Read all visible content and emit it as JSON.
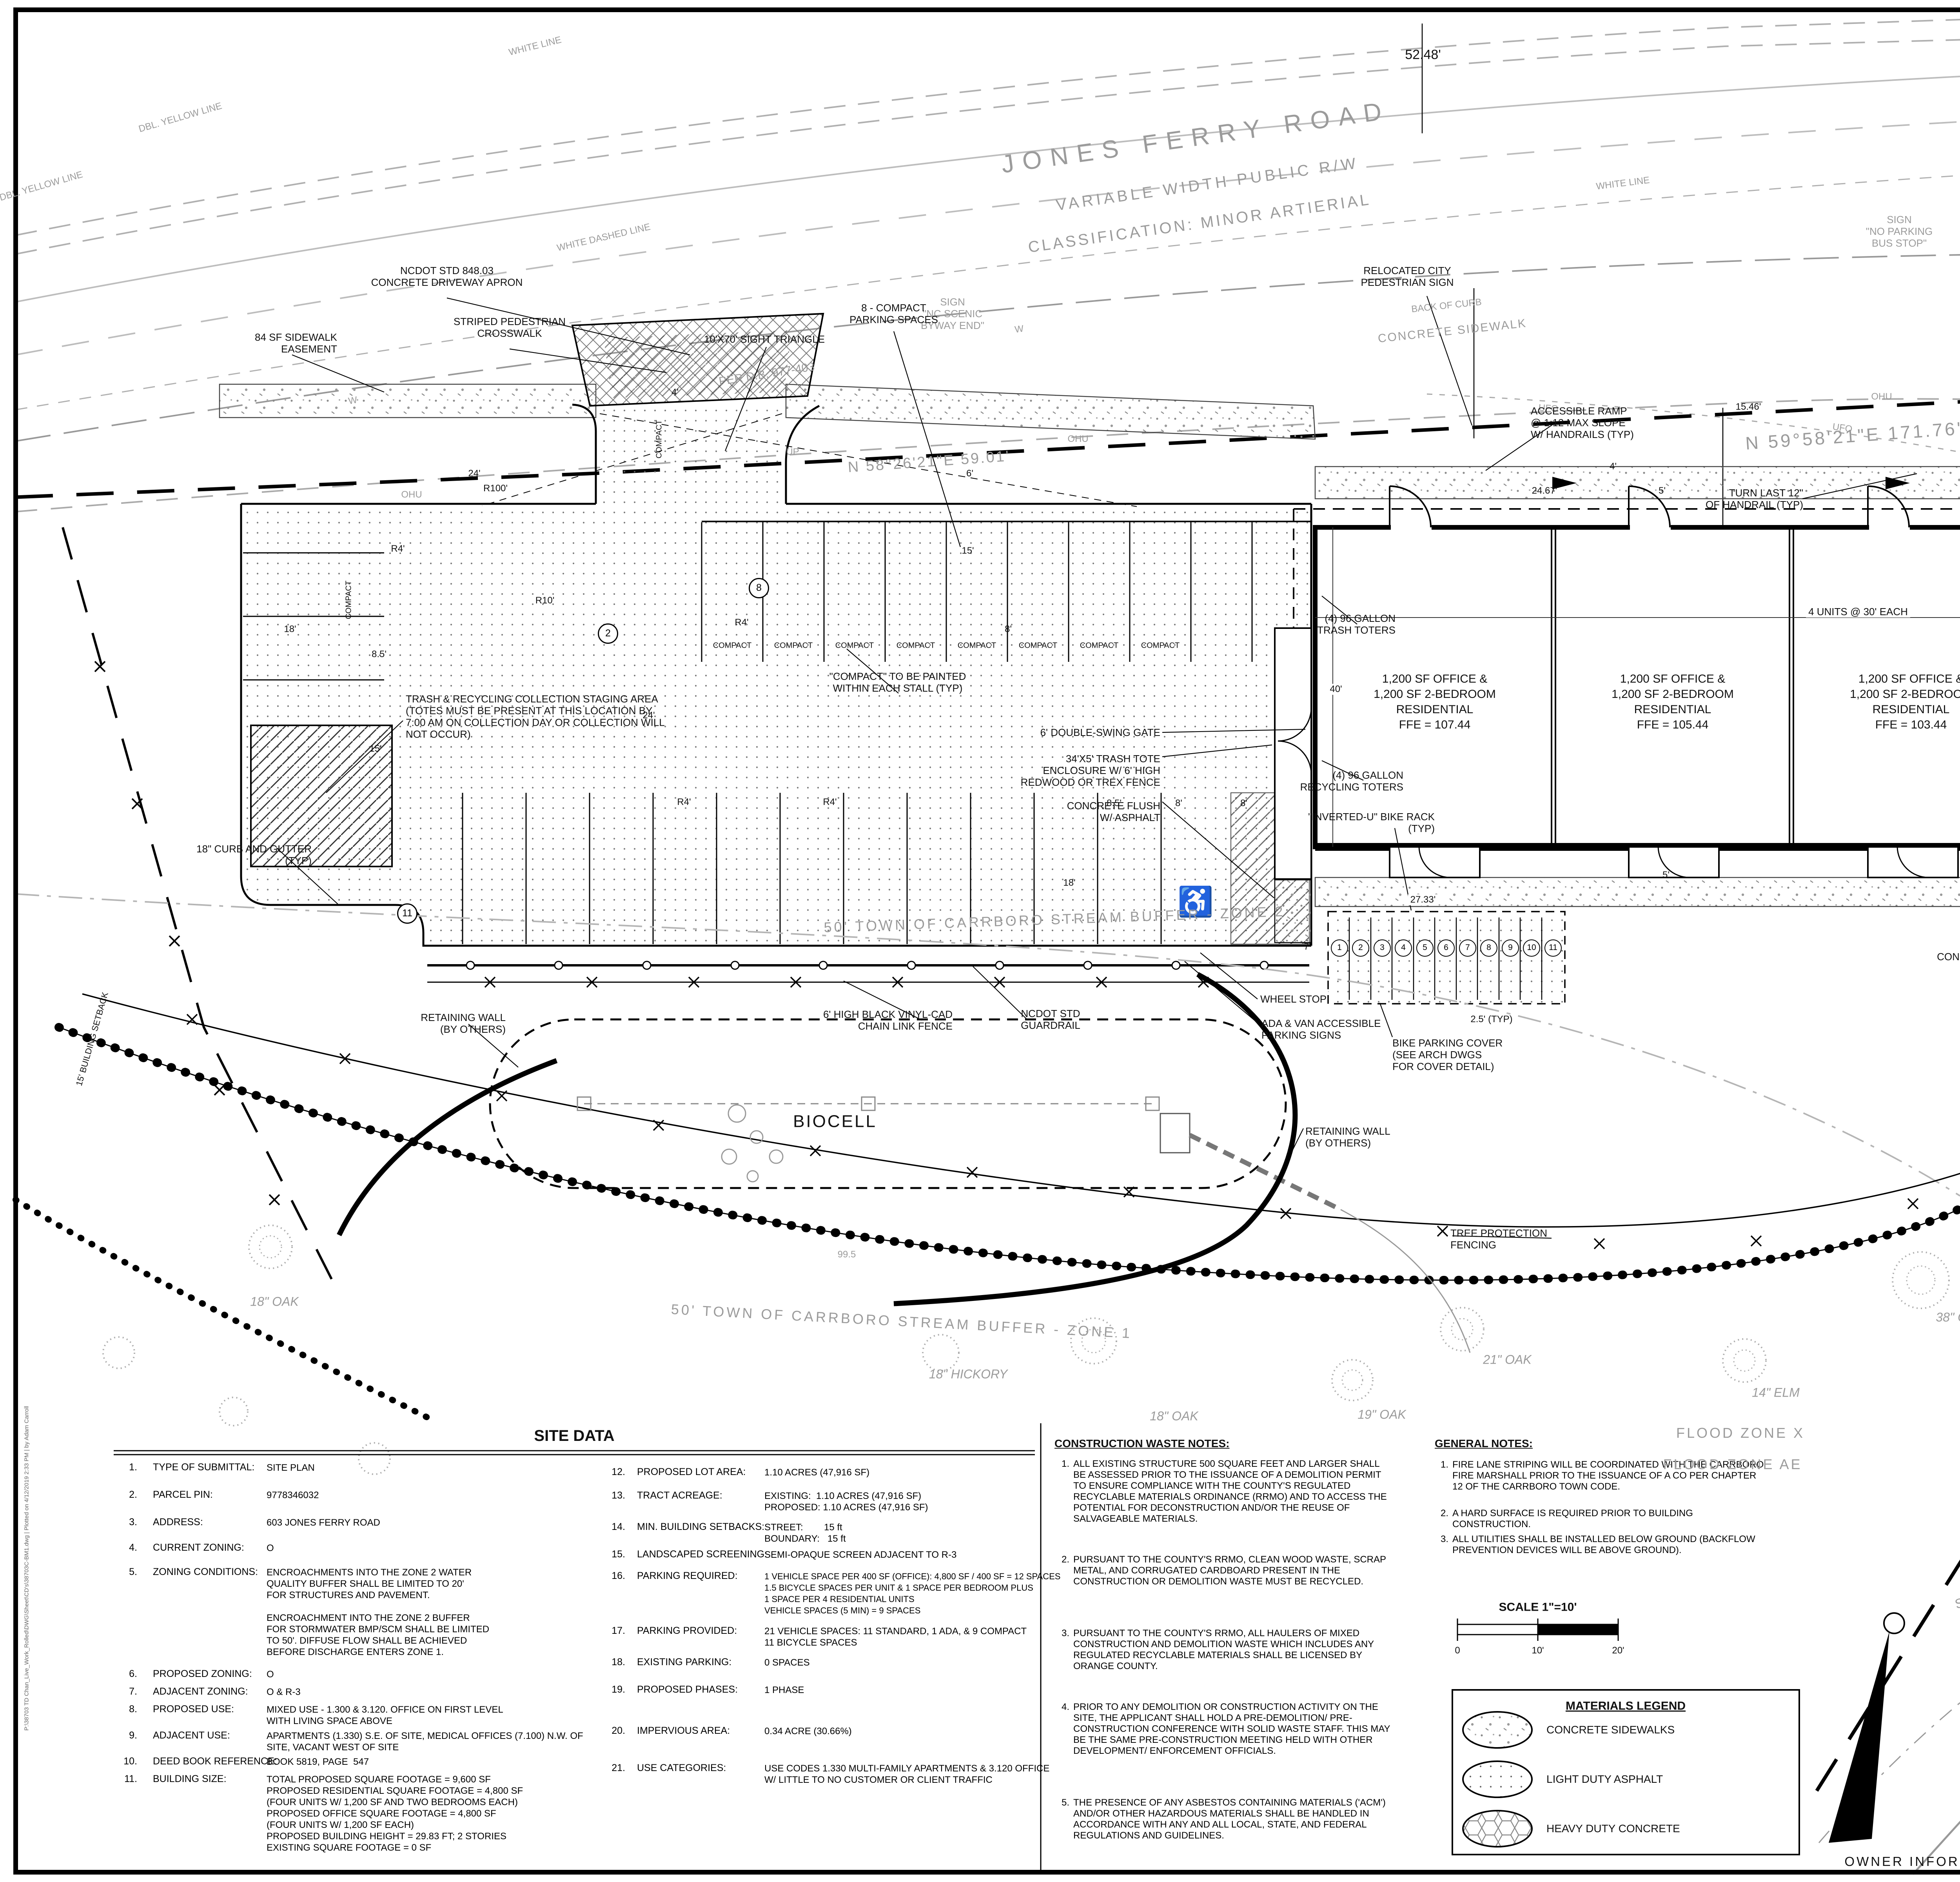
{
  "road": {
    "name": "JONES FERRY ROAD",
    "rw": "VARIABLE WIDTH PUBLIC R/W",
    "classification": "CLASSIFICATION: MINOR ARTIERIAL",
    "dim_5248": "52.48'",
    "dbl_yellow": "DBL. YELLOW LINE",
    "white_line": "WHITE LINE",
    "white_dashed": "WHITE DASHED LINE",
    "back_of_curb": "BACK OF CURB",
    "concrete_sidewalk": "CONCRETE SIDEWALK",
    "w": "W",
    "ohu": "OHU",
    "ufo": "UFO",
    "up": "UP",
    "per_db_977": "PER D.B. 977-403",
    "per_db_885": "PER D.B. 885-233",
    "bearing_n59": "N 59°58'21\"E  171.76'",
    "bearing_n58": "N 58°26'21\"E  59.01'"
  },
  "labels": {
    "sign_scenic": "SIGN\n\"NC SCENIC\nBYWAY END\"",
    "sign_bus": "SIGN\n\"NO PARKING\nBUS STOP\"",
    "sign_jct": "SIGN\n\"JCT 54\"",
    "relocated_sign": "RELOCATED CITY\nPEDESTRIAN SIGN",
    "ncdot_apron": "NCDOT STD 848.03\nCONCRETE DRIVEWAY APRON",
    "sidewalk_easement": "84 SF SIDEWALK\nEASEMENT",
    "crosswalk": "STRIPED PEDESTRIAN\nCROSSWALK",
    "sight_triangle": "10'X70' SIGHT TRIANGLE",
    "compact_8": "8 - COMPACT\nPARKING SPACES",
    "compact": "COMPACT",
    "compact_note": "\"COMPACT\" TO BE PAINTED\nWITHIN EACH STALL (TYP)",
    "gate": "6' DOUBLE-SWING GATE",
    "tote_enclosure": "34'X5' TRASH TOTE\nENCLOSURE W/ 6' HIGH\nREDWOOD OR TREX FENCE",
    "conc_flush": "CONCRETE FLUSH\nW/ ASPHALT",
    "trash_staging": "TRASH & RECYCLING COLLECTION STAGING AREA\n(TOTES MUST BE PRESENT AT THIS LOCATION BY\n7:00 AM ON COLLECTION DAY OR COLLECTION WILL\nNOT OCCUR)",
    "curb_gutter": "18\" CURB AND GUTTER\n(TYP)",
    "stream_zone2": "50' TOWN OF CARRBORO STREAM BUFFER - ZONE 2",
    "stream_zone1": "50' TOWN OF CARRBORO STREAM BUFFER - ZONE 1",
    "setback_15": "15' BUILDING SETBACK",
    "trash_toters": "(4) 96 GALLON\nTRASH TOTERS",
    "recycle_toters": "(4) 96 GALLON\nRECYCLING TOTERS",
    "bike_rack": "\"INVERTED-U\" BIKE RACK\n(TYP)",
    "units_dim": "4 UNITS @ 30' EACH",
    "stair_room": "STAIR ROOM",
    "accessible_ramp": "ACCESSIBLE RAMP\n@ 1:12 MAX SLOPE\nW/ HANDRAILS (TYP)",
    "turn_handrail": "TURN LAST 12\"\nOF HANDRAIL (TYP)",
    "service_conn": "1\" SERVICE CONNECTION\nFOR DOMESTIC LINE",
    "tapping_sleeve": "4\" TAPPING SLEEVE\nAND VALVE TO CONNECT\nTO EXISTING WATERLINE",
    "bend_1": "1\" 90° BEND",
    "bend_4": "4\" 90° BEND",
    "water_meter": "1\" WATER METER\nAND VAULT",
    "rpz_1": "1\" RPZ BACKFLOW\nPREVENTER IN HEATED\nABOVE GOUND ENCLOSURE",
    "rpz_4": "4\" RPZ BACKFLOW\nPREVENTER IN HEATED\nABOVE GROUND\nENCLOSURE",
    "hydrant": "HYDRANT\nASSEMBLY",
    "fdc": "SIAMESE FDC",
    "fire_line": "4\" FIRE PROTECTION\nWATERLINE",
    "conc_sidewalk_r": "CONC. SIDEWALK",
    "guy_wire": "GUY-W",
    "fiber": "UNDERGROUND\nFIBER OPTIC\nDUCT BANK",
    "sanitary_cleanout": "SANITARY\nCLEANOUT (TYP)",
    "concrete_stair": "CONCRETE STAIR\n(TYP)",
    "wheel_stop": "WHEEL STOP",
    "ada_signs": "ADA & VAN ACCESSIBLE\nPARKING SIGNS",
    "bike_cover": "BIKE PARKING COVER\n(SEE ARCH DWGS\nFOR COVER DETAIL)",
    "retaining_wall": "RETAINING WALL\n(BY OTHERS)",
    "biocell": "BIOCELL",
    "contour_995": "99.5",
    "ncdot_guardrail": "NCDOT STD\nGUARDRAIL",
    "chain_fence": "6' HIGH BLACK VINYL-CAD\nCHAIN LINK FENCE",
    "tree_protection": "TREE PROTECTION\nFENCING",
    "san_4": "4\"SAN",
    "pvc_sewer": "4\" PVC SANITARY\nSEWER LINE",
    "connect_sewer": "CONNECT 4\" SEWERLINE\nTO EXISTING MANHOLE",
    "sewer_line_lbl": "SANITARY SEWER LINE",
    "sewer_easement": "30.0' SANITARY SEWER EASEMENT\nPER D.B. 243-206  &  P.B. 37-06",
    "edge_creek": "EDGE OF\nCREEK BANK",
    "creek": "CREEK",
    "flood_x": "FLOOD ZONE X",
    "flood_ae": "FLOOD ZONE AE",
    "ada_symbol": "♿"
  },
  "dims": {
    "d24": "24'",
    "r100": "R100'",
    "r4": "R4'",
    "r10": "R10'",
    "d18": "18'",
    "d85": "8.5'",
    "d15": "15'",
    "d8": "8'",
    "d6": "6'",
    "d40": "40'",
    "d7": "7'",
    "d5": "5'",
    "d4": "4'",
    "d2467": "24.67'",
    "d1546": "15.46'",
    "d1574": "15.74'",
    "d2733": "27.33'",
    "d25typ": "2.5' (TYP)"
  },
  "plan": {
    "circled": {
      "c2": "2",
      "c8": "8",
      "c11": "11"
    },
    "bike_numbers": [
      "1",
      "2",
      "3",
      "4",
      "5",
      "6",
      "7",
      "8",
      "9",
      "10",
      "11"
    ],
    "units": [
      "1,200 SF OFFICE &\n1,200 SF 2-BEDROOM\nRESIDENTIAL\nFFE = 107.44",
      "1,200 SF OFFICE &\n1,200 SF 2-BEDROOM\nRESIDENTIAL\nFFE = 105.44",
      "1,200 SF OFFICE &\n1,200 SF 2-BEDROOM\nRESIDENTIAL\nFFE = 103.44",
      "1,200 SF OFFICE &\n1,200 SF 2-BEDROOM\nRESIDENTIAL\nFFE = 101.44"
    ],
    "trees": {
      "oak18": "18\" OAK",
      "hickory18": "18\" HICKORY",
      "oak19": "19\" OAK",
      "oak21": "21\" OAK",
      "elm14": "14\" ELM",
      "elm13": "13\" ELM",
      "oak38": "38\" OAK",
      "sourwood13": "13\" SOURWOOD",
      "oak26": "26\" OAK",
      "beech12": "12\" BEECH"
    }
  },
  "site_data": {
    "title": "SITE DATA",
    "items": [
      {
        "n": "1.",
        "label": "TYPE OF SUBMITTAL:",
        "value": "SITE PLAN"
      },
      {
        "n": "2.",
        "label": "PARCEL PIN:",
        "value": "9778346032"
      },
      {
        "n": "3.",
        "label": "ADDRESS:",
        "value": "603 JONES FERRY ROAD"
      },
      {
        "n": "4.",
        "label": "CURRENT ZONING:",
        "value": "O"
      },
      {
        "n": "5.",
        "label": "ZONING CONDITIONS:",
        "value": "ENCROACHMENTS INTO THE ZONE 2 WATER\nQUALITY BUFFER SHALL BE LIMITED TO 20'\nFOR STRUCTURES AND PAVEMENT.\n\nENCROACHMENT INTO THE ZONE 2 BUFFER\nFOR STORMWATER BMP/SCM SHALL BE LIMITED\nTO 50'. DIFFUSE FLOW SHALL BE ACHIEVED\nBEFORE DISCHARGE ENTERS ZONE 1."
      },
      {
        "n": "6.",
        "label": "PROPOSED ZONING:",
        "value": "O"
      },
      {
        "n": "7.",
        "label": "ADJACENT ZONING:",
        "value": "O & R-3"
      },
      {
        "n": "8.",
        "label": "PROPOSED USE:",
        "value": "MIXED USE - 1.300 & 3.120. OFFICE ON FIRST LEVEL\nWITH LIVING SPACE ABOVE"
      },
      {
        "n": "9.",
        "label": "ADJACENT USE:",
        "value": "APARTMENTS (1.330) S.E. OF SITE, MEDICAL OFFICES (7.100) N.W. OF\nSITE, VACANT WEST OF SITE"
      },
      {
        "n": "10.",
        "label": "DEED BOOK REFERENCE:",
        "value": "BOOK 5819, PAGE  547"
      },
      {
        "n": "11.",
        "label": "BUILDING SIZE:",
        "value": "TOTAL PROPOSED SQUARE FOOTAGE = 9,600 SF\nPROPOSED RESIDENTIAL SQUARE FOOTAGE = 4,800 SF\n(FOUR UNITS W/ 1,200 SF AND TWO BEDROOMS EACH)\nPROPOSED OFFICE SQUARE FOOTAGE = 4,800 SF\n(FOUR UNITS W/ 1,200 SF EACH)\nPROPOSED BUILDING HEIGHT = 29.83 FT; 2 STORIES\nEXISTING SQUARE FOOTAGE = 0 SF"
      },
      {
        "n": "12.",
        "label": "PROPOSED LOT AREA:",
        "value": "1.10 ACRES (47,916 SF)"
      },
      {
        "n": "13.",
        "label": "TRACT ACREAGE:",
        "value": "EXISTING:  1.10 ACRES (47,916 SF)\nPROPOSED: 1.10 ACRES (47,916 SF)"
      },
      {
        "n": "14.",
        "label": "MIN. BUILDING SETBACKS:",
        "value": "STREET:        15 ft\nBOUNDARY:   15 ft"
      },
      {
        "n": "15.",
        "label": "LANDSCAPED SCREENING:",
        "value": "SEMI-OPAQUE SCREEN ADJACENT TO R-3"
      },
      {
        "n": "16.",
        "label": "PARKING REQUIRED:",
        "value": "1 VEHICLE SPACE PER 400 SF (OFFICE): 4,800 SF / 400 SF = 12 SPACES\n1.5 BICYCLE SPACES PER UNIT & 1 SPACE PER BEDROOM PLUS\n1 SPACE PER 4 RESIDENTIAL UNITS\nVEHICLE SPACES (5 MIN) = 9 SPACES"
      },
      {
        "n": "17.",
        "label": "PARKING PROVIDED:",
        "value": "21 VEHICLE SPACES: 11 STANDARD, 1 ADA, & 9 COMPACT\n11 BICYCLE SPACES"
      },
      {
        "n": "18.",
        "label": "EXISTING PARKING:",
        "value": "0 SPACES"
      },
      {
        "n": "19.",
        "label": "PROPOSED PHASES:",
        "value": "1 PHASE"
      },
      {
        "n": "20.",
        "label": "IMPERVIOUS AREA:",
        "value": "0.34 ACRE (30.66%)"
      },
      {
        "n": "21.",
        "label": "USE CATEGORIES:",
        "value": "USE CODES 1.330 MULTI-FAMILY APARTMENTS & 3.120 OFFICE\nW/ LITTLE TO NO CUSTOMER OR CLIENT TRAFFIC"
      }
    ]
  },
  "construction_notes": {
    "title": "CONSTRUCTION WASTE NOTES:",
    "items": [
      {
        "n": "1.",
        "text": "ALL EXISTING STRUCTURE 500 SQUARE FEET AND LARGER SHALL BE ASSESSED PRIOR TO THE ISSUANCE OF A DEMOLITION PERMIT TO ENSURE COMPLIANCE WITH THE COUNTY'S REGULATED RECYCLABLE MATERIALS ORDINANCE (RRMO) AND TO ACCESS THE POTENTIAL FOR DECONSTRUCTION AND/OR THE REUSE OF SALVAGEABLE MATERIALS."
      },
      {
        "n": "2.",
        "text": "PURSUANT TO THE COUNTY'S RRMO, CLEAN WOOD WASTE, SCRAP METAL, AND CORRUGATED CARDBOARD PRESENT IN THE CONSTRUCTION OR DEMOLITION WASTE MUST BE RECYCLED."
      },
      {
        "n": "3.",
        "text": "PURSUANT TO THE COUNTY'S RRMO, ALL HAULERS OF MIXED CONSTRUCTION AND DEMOLITION WASTE WHICH INCLUDES ANY REGULATED RECYCLABLE MATERIALS SHALL BE LICENSED BY ORANGE COUNTY."
      },
      {
        "n": "4.",
        "text": "PRIOR TO ANY DEMOLITION OR CONSTRUCTION ACTIVITY ON THE SITE, THE APPLICANT SHALL HOLD A PRE-DEMOLITION/ PRE-CONSTRUCTION CONFERENCE WITH SOLID WASTE STAFF. THIS MAY BE THE SAME PRE-CONSTRUCTION MEETING HELD WITH OTHER DEVELOPMENT/ ENFORCEMENT OFFICIALS."
      },
      {
        "n": "5.",
        "text": "THE PRESENCE OF ANY ASBESTOS CONTAINING MATERIALS ('ACM') AND/OR OTHER HAZARDOUS MATERIALS SHALL BE HANDLED IN ACCORDANCE WITH ANY AND ALL LOCAL, STATE, AND FEDERAL REGULATIONS AND GUIDELINES."
      }
    ]
  },
  "general_notes": {
    "title": "GENERAL NOTES:",
    "items": [
      {
        "n": "1.",
        "text": "FIRE LANE STRIPING WILL BE COORDINATED WITH THE CARRBORO FIRE MARSHALL PRIOR TO THE ISSUANCE OF A CO PER CHAPTER 12 OF THE CARRBORO TOWN CODE."
      },
      {
        "n": "2.",
        "text": "A HARD SURFACE IS REQUIRED PRIOR TO BUILDING CONSTRUCTION."
      },
      {
        "n": "3.",
        "text": "ALL UTILITIES SHALL BE INSTALLED BELOW GROUND (BACKFLOW PREVENTION DEVICES WILL BE ABOVE GROUND)."
      }
    ]
  },
  "scale_block": {
    "title": "SCALE 1\"=10'",
    "t0": "0",
    "t1": "10'",
    "t2": "20'"
  },
  "materials_legend": {
    "title": "MATERIALS LEGEND",
    "items": [
      "CONCRETE SIDEWALKS",
      "LIGHT DUTY ASPHALT",
      "HEAVY DUTY CONCRETE"
    ]
  },
  "titleblock": {
    "seal": {
      "state": "NORTH CAROLINA",
      "professional": "PROFESSIONAL",
      "seal_word": "SEAL",
      "number": "38573",
      "date": "4-12-18",
      "engineer": "ENGINEER",
      "name": "JOSEPH  A.  CARROLL"
    },
    "prepared": {
      "line1": "THIS DRAWING PREPARED AT THE",
      "office": "GREENSBORO OFFICE",
      "address": "8642 W. Market Street Suite 136 | Greensboro, NC 27409",
      "phone": "TEL 336.662.0411  FAX 336.662.0420  www.timmons.com",
      "license": "NC License No. C-1652"
    },
    "tagline": "YOUR VISION ACHIEVED THROUGH OURS.",
    "logo": "TIMMONS GROUP",
    "revisions": {
      "date_header": "DATE",
      "desc_header": "REVISION DESCRIPTION",
      "rows": [
        {
          "date": "12/19/2017",
          "desc": "TOWN OF CARRBORO REVIEW COMMENTS"
        },
        {
          "date": "03/09/2018",
          "desc": "TOWN OF CARRBORO REVIEW COMMENTS"
        },
        {
          "date": "04/12/2018",
          "desc": "TOWN OF CARRBORO REVIEW COMMENTS"
        }
      ]
    },
    "info": {
      "date_label": "DATE",
      "date": "07/06/2017",
      "drawn_label": "DRAWN BY",
      "drawn": "J. MOORE",
      "designed_label": "DESIGNED BY",
      "designed": "J. MOORE",
      "checked_label": "CHECKED BY",
      "checked": "A. CARROLL",
      "scale_label": "SCALE",
      "scale": "1\" = 10'"
    },
    "project_title": "FRANCIS CHAN MIXED USE BUILDING - CONDITIONAL USE PERMIT",
    "project_subtitle": "TOWN OF CARRBORO - ORANGE COUNTY - NORTH CAROLINA",
    "sheet_title": "SITE LAYOUT AND UTILITY PLAN",
    "job_label": "JOB NO.",
    "job_no": "38703",
    "sheet_label": "SHEET NO.",
    "sheet_no": "C3.0",
    "disclaimer": "These plans and associated documents are the exclusive property of TIMMONS GROUP and may not be reproduced in whole or in part and shall not be used for any purpose whatsoever, inclusive, but not limited to construction, bidding, and/or construction staking without the express written consent of TIMMONS GROUP.",
    "owner_info": "OWNER INFORMATION: FRANCIS CHAN; 101 HARKNESS CIRCLE, DURHAM, NC 27705; FRANCISCHAN66@GMAIL.COM",
    "plot_info": "P:\\38703 TD Chan_Live_Work_Rolled\\DWG\\Sheet\\CD's\\38703C-BM1.dwg | Plotted on 4/12/2019 2:33 PM | by Adam Carroll"
  }
}
